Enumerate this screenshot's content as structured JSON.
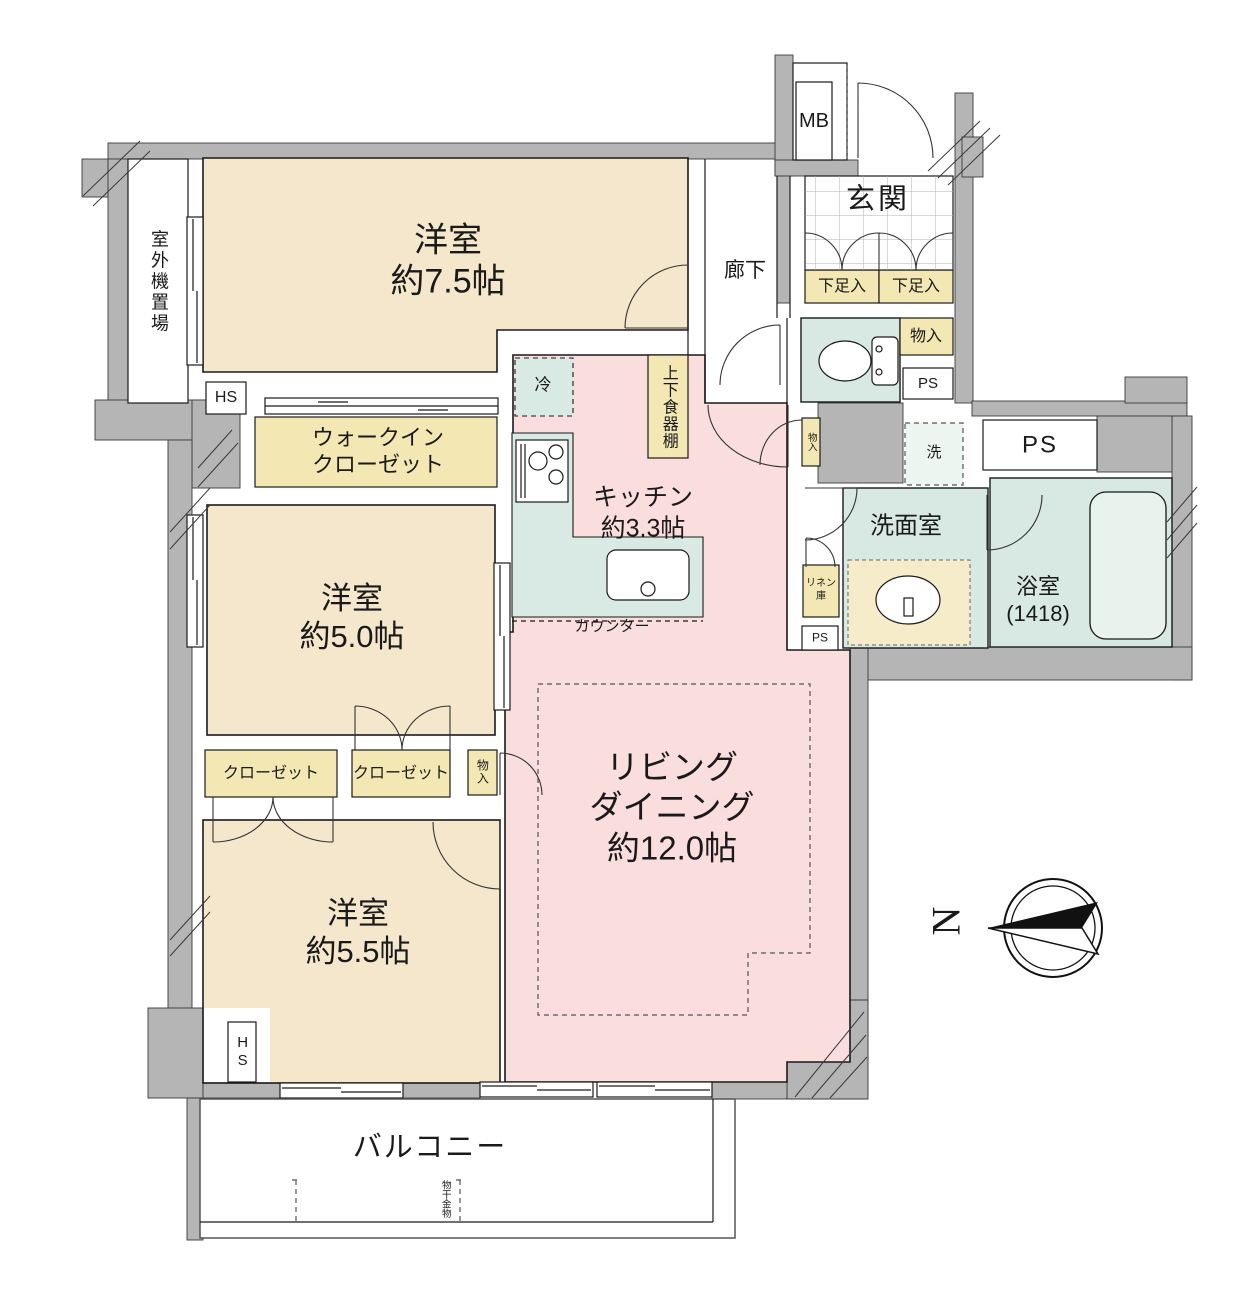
{
  "palette": {
    "wall_gray": "#b5b5b5",
    "room_beige": "#f5e7cb",
    "closet_yellow": "#f3e7b4",
    "living_pink": "#fadddd",
    "wet_green": "#d8e8e2",
    "counter_green": "#d9e9e3",
    "background": "#ffffff",
    "text": "#1a1a1a"
  },
  "rooms": {
    "western75": {
      "name": "洋室",
      "size": "約7.5帖"
    },
    "western50": {
      "name": "洋室",
      "size": "約5.0帖"
    },
    "western55": {
      "name": "洋室",
      "size": "約5.5帖"
    },
    "living": {
      "line1": "リビング",
      "line2": "ダイニング",
      "size": "約12.0帖"
    },
    "kitchen": {
      "name": "キッチン",
      "size": "約3.3帖"
    },
    "genkan": "玄関",
    "corridor": "廊下",
    "washroom": "洗面室",
    "bathroom": {
      "name": "浴室",
      "size": "(1418)"
    },
    "balcony": "バルコニー",
    "outdoor_unit": "室外機置場",
    "wic": {
      "line1": "ウォークイン",
      "line2": "クローゼット"
    }
  },
  "storage": {
    "closet_left": "クローゼット",
    "closet_center": "クローゼット",
    "monoire_ld": "物入",
    "monoire_toilet": "物入",
    "monoire_small": "物入",
    "shoe_left": "下足入",
    "shoe_right": "下足入",
    "dish_shelf": "上下食器棚",
    "linen": "リネン庫",
    "counter": "カウンター",
    "fridge": "冷",
    "washer": "洗",
    "laundry_hook": "物干金物"
  },
  "utility": {
    "ps_toilet": "PS",
    "ps_large": "PS",
    "ps_linen": "PS",
    "mb": "MB",
    "hs_top": "HS",
    "hs_bottom": "HS"
  },
  "compass": {
    "north": "N"
  }
}
